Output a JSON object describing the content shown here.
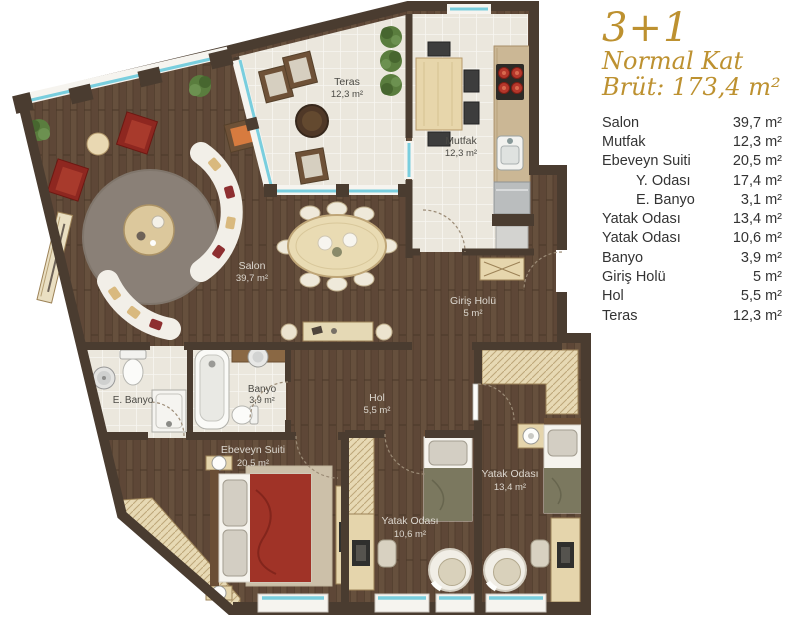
{
  "header": {
    "type": "3+1",
    "floor": "Normal Kat",
    "gross": "Brüt: 173,4 m²"
  },
  "legend": {
    "rows": [
      {
        "label": "Salon",
        "value": "39,7 m²",
        "indent": false
      },
      {
        "label": "Mutfak",
        "value": "12,3 m²",
        "indent": false
      },
      {
        "label": "Ebeveyn Suiti",
        "value": "20,5 m²",
        "indent": false
      },
      {
        "label": "Y. Odası",
        "value": "17,4 m²",
        "indent": true
      },
      {
        "label": "E. Banyo",
        "value": "3,1 m²",
        "indent": true
      },
      {
        "label": "Yatak Odası",
        "value": "13,4 m²",
        "indent": false
      },
      {
        "label": "Yatak Odası",
        "value": "10,6 m²",
        "indent": false
      },
      {
        "label": "Banyo",
        "value": "3,9 m²",
        "indent": false
      },
      {
        "label": "Giriş Holü",
        "value": "5 m²",
        "indent": false
      },
      {
        "label": "Hol",
        "value": "5,5 m²",
        "indent": false
      },
      {
        "label": "Teras",
        "value": "12,3 m²",
        "indent": false
      }
    ]
  },
  "plan": {
    "rooms": {
      "salon": {
        "name": "Salon",
        "area": "39,7 m²"
      },
      "teras": {
        "name": "Teras",
        "area": "12,3 m²"
      },
      "mutfak": {
        "name": "Mutfak",
        "area": "12,3 m²"
      },
      "giris_holu": {
        "name": "Giriş Holü",
        "area": "5 m²"
      },
      "e_banyo": {
        "name": "E. Banyo"
      },
      "banyo": {
        "name": "Banyo",
        "area": "3,9 m²"
      },
      "hol": {
        "name": "Hol",
        "area": "5,5 m²"
      },
      "ebeveyn_suiti": {
        "name": "Ebeveyn Suiti",
        "area": "20,5 m²"
      },
      "yatak_odasi_13": {
        "name": "Yatak Odası",
        "area": "13,4 m²"
      },
      "yatak_odasi_10": {
        "name": "Yatak Odası",
        "area": "10,6 m²"
      }
    }
  },
  "colors": {
    "accent_gold": "#bd9130",
    "legend_text": "#333333",
    "wall": "#4a3c30",
    "wood_floor": "#5e4737",
    "light_tile": "#ebe7dd",
    "window_blue": "#79cede",
    "sofa_white": "#f2efe8",
    "armchair_red": "#8e2720",
    "bed_red": "#a03327",
    "furniture_beige": "#e5d5ac",
    "rug_taupe": "#8a8077"
  }
}
